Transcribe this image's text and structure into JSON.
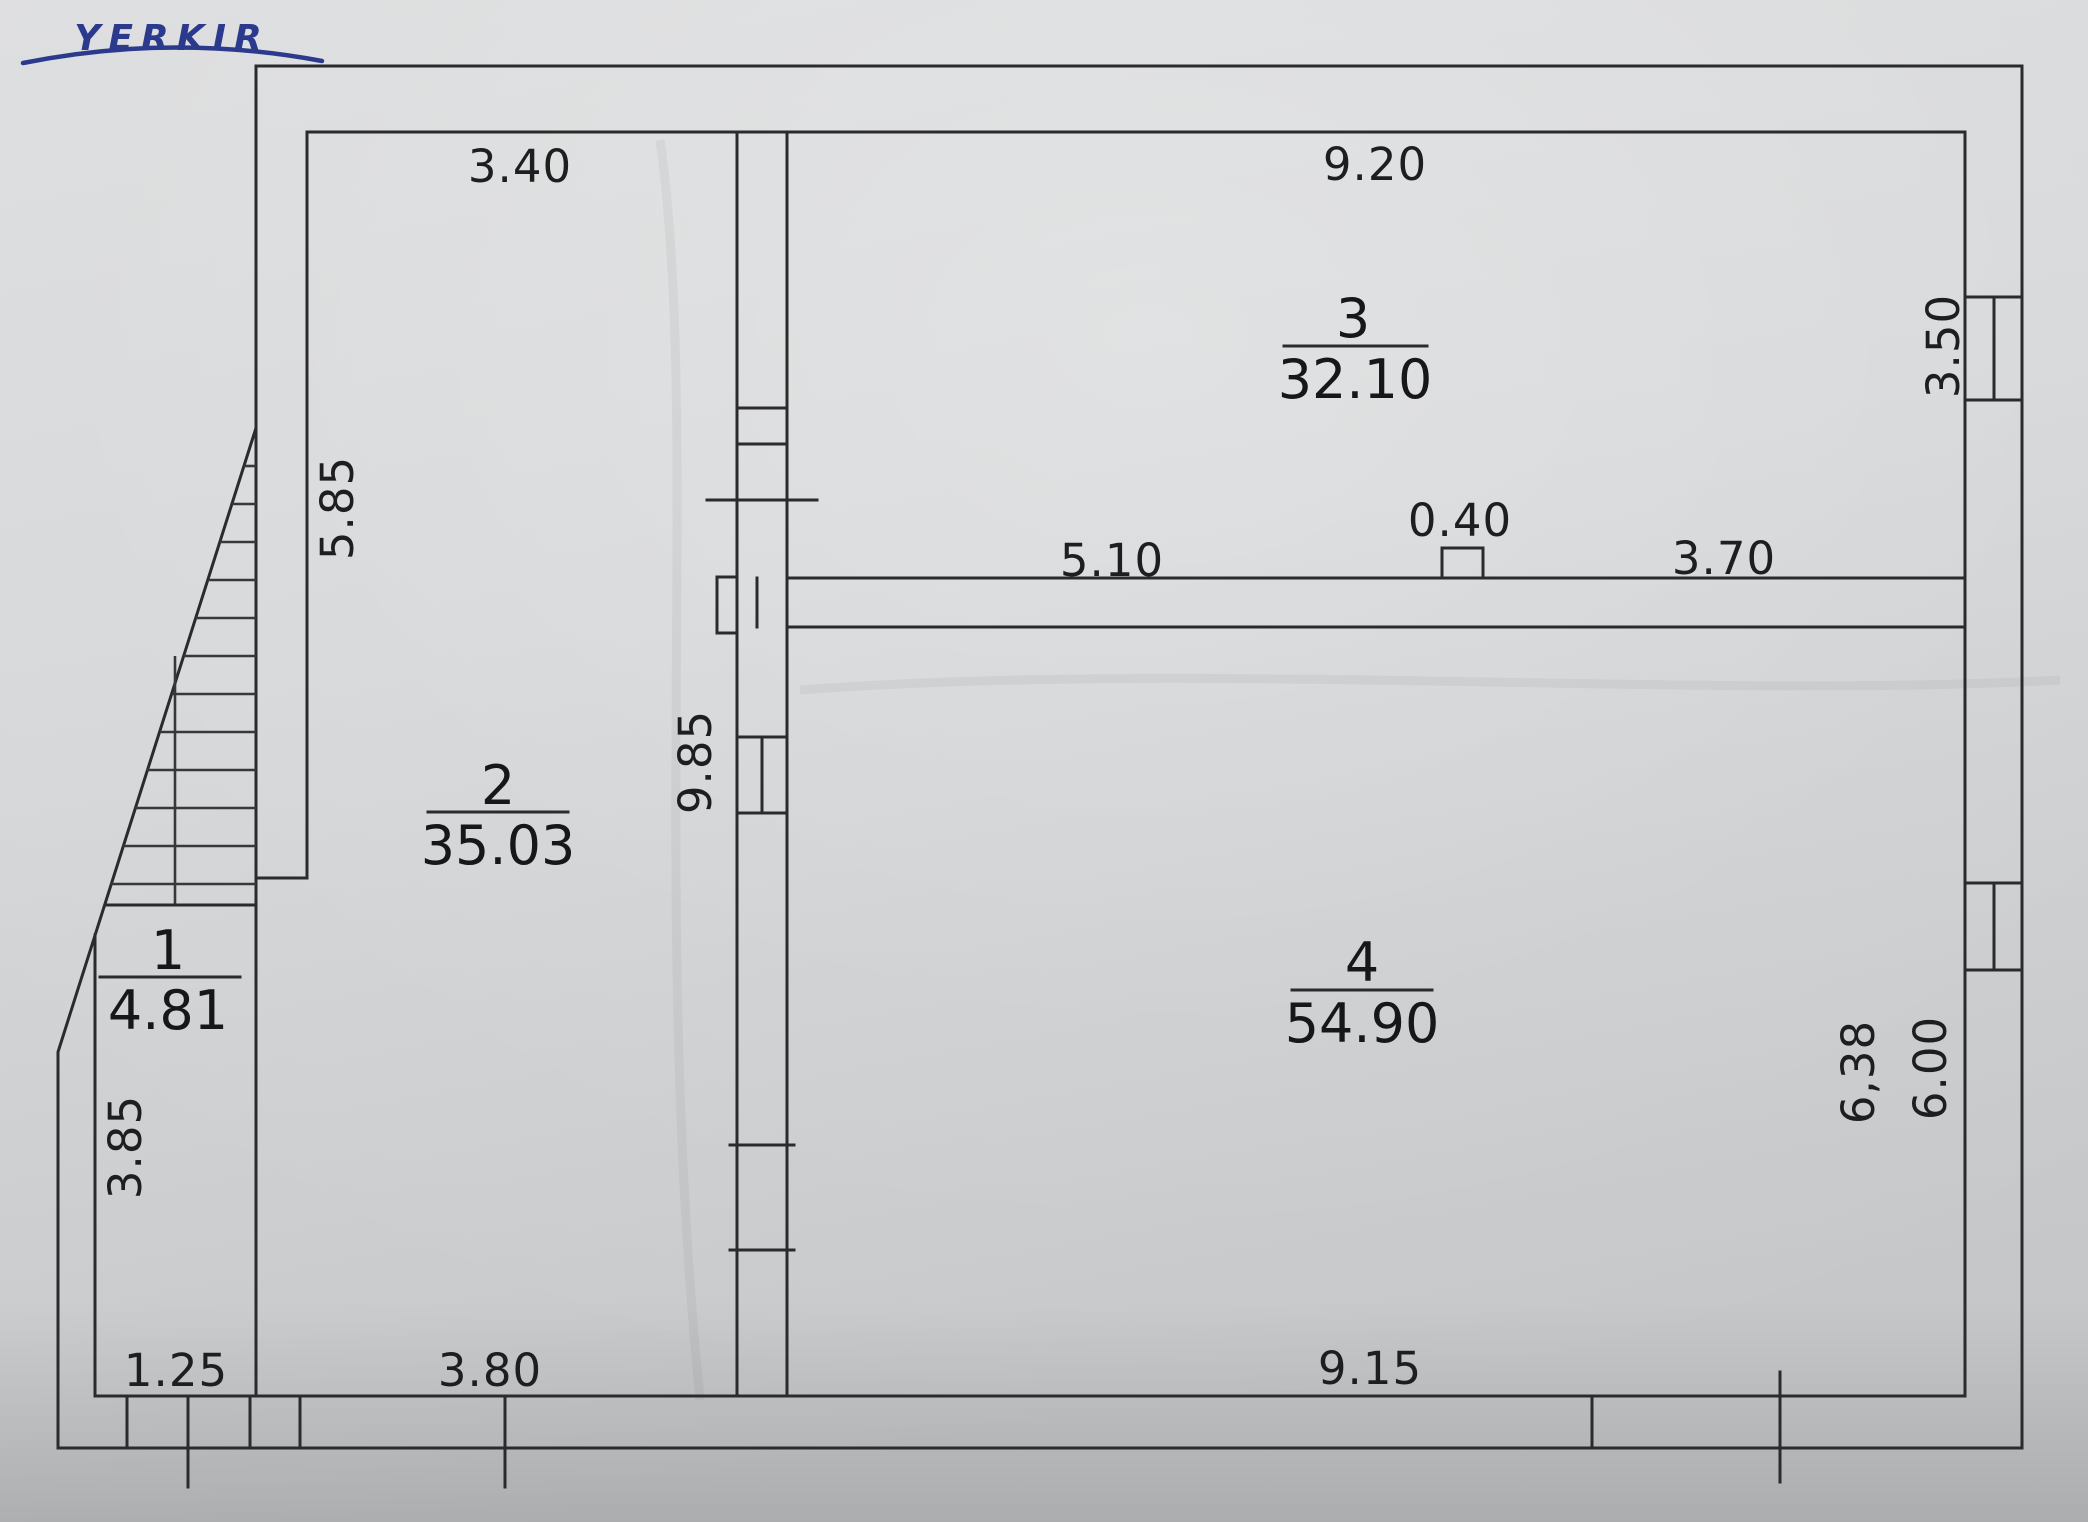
{
  "logo": {
    "text": "YERKIR"
  },
  "rooms": [
    {
      "number": "1",
      "area": "4.81"
    },
    {
      "number": "2",
      "area": "35.03"
    },
    {
      "number": "3",
      "area": "32.10"
    },
    {
      "number": "4",
      "area": "54.90"
    }
  ],
  "dimensions": {
    "room2_top": "3.40",
    "room3_top": "9.20",
    "room3_right_window": "3.50",
    "room2_left": "5.85",
    "center_wall": "9.85",
    "notch": "0.40",
    "room3_bottom_left": "5.10",
    "room3_bottom_right": "3.70",
    "room4_right_outer": "6,38",
    "room4_right_inner": "6.00",
    "room1_left": "3.85",
    "room1_bottom": "1.25",
    "room2_bottom": "3.80",
    "room4_bottom": "9.15"
  },
  "colors": {
    "paper": "#d7d8da",
    "line": "#2b2b2e",
    "logo_blue": "#2c3a8e",
    "text": "#1e1e20"
  }
}
